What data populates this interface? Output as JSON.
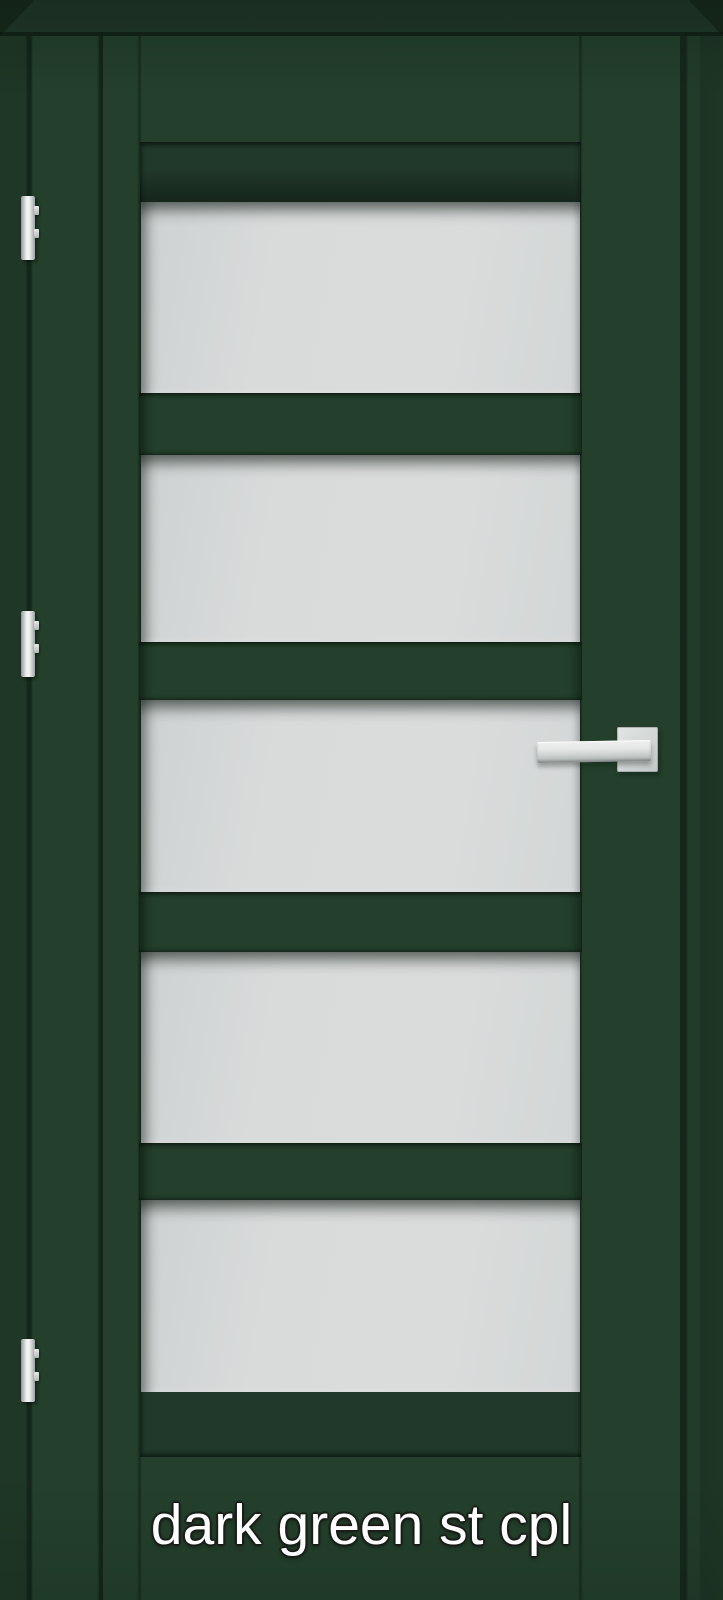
{
  "caption": {
    "label": "dark green st cpl"
  },
  "door": {
    "description": "dark green interior door with five frosted glass panels, three hinges and a silver lever handle",
    "glass_panel_count": 5,
    "hinge_count": 3,
    "colors": {
      "door_green": "#24402c",
      "recess_green": "#21392a",
      "frame_shadow_green": "#1f3726",
      "glass_gray": "#d8dada",
      "hardware_silver": "#e8eaea",
      "caption_white": "#ffffff"
    }
  }
}
